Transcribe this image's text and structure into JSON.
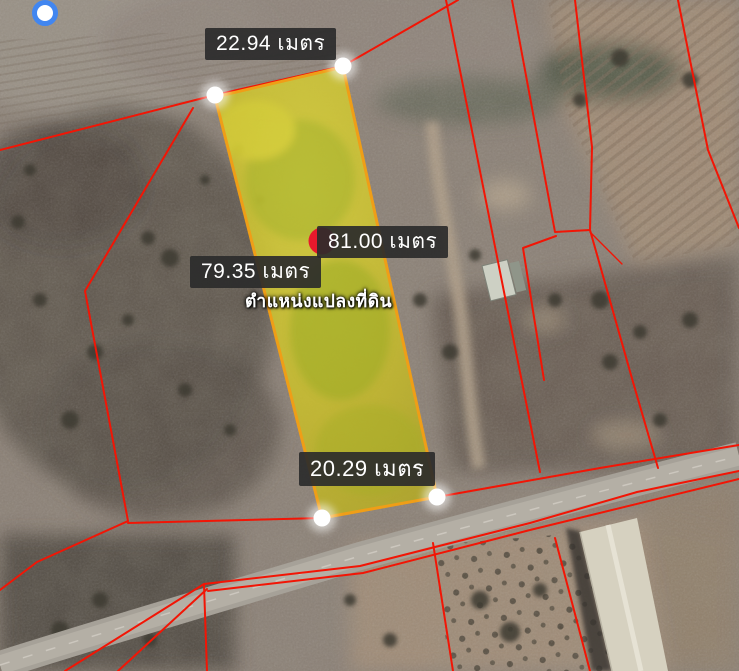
{
  "map": {
    "caption": "ตำแหน่งแปลงที่ดิน",
    "measurements": {
      "top": "22.94 เมตร",
      "side_right": "81.00 เมตร",
      "side_left": "79.35 เมตร",
      "bottom": "20.29 เมตร"
    },
    "icons": {
      "my_location": "my-location-icon",
      "vertex_marker": "vertex-marker-icon",
      "parcel_pin": "red-pin-icon"
    },
    "colors": {
      "boundary_line": "#f21505",
      "parcel_fill": "#cdc22e",
      "parcel_border": "#ef9e17",
      "label_background": "#2b2b2b",
      "label_text": "#ffffff",
      "my_location_ring": "#4186f0",
      "pin_red": "#e8192c",
      "vertex_white": "#ffffff"
    }
  }
}
